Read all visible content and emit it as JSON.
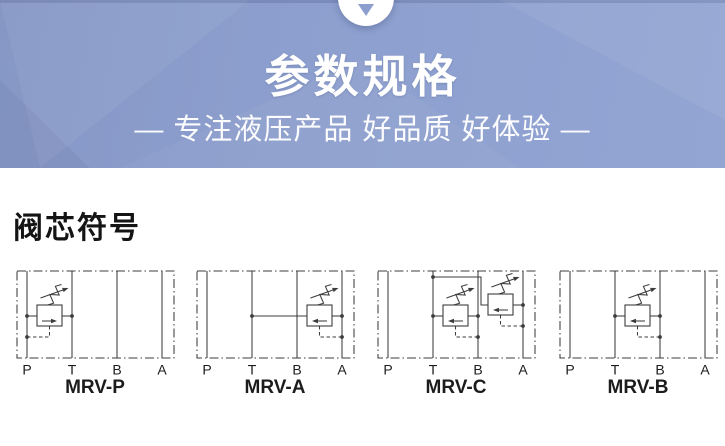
{
  "header": {
    "title": "参数规格",
    "subtitle": "— 专注液压产品  好品质  好体验 —",
    "background_color": "#8c9ecd",
    "text_color": "#ffffff",
    "scroll_indicator_icon": "chevron-down"
  },
  "valve_section": {
    "heading": "阀芯符号",
    "port_labels": [
      "P",
      "T",
      "B",
      "A"
    ],
    "line_color": "#3c3c3c",
    "diagrams": [
      {
        "name": "MRV-P",
        "valves": [
          {
            "relief_from": "P",
            "relief_to": "T",
            "between": [
              "P",
              "T"
            ],
            "flow_arrow": "right",
            "pilot_sense": "P",
            "raised": false
          }
        ]
      },
      {
        "name": "MRV-A",
        "valves": [
          {
            "relief_from": "A",
            "relief_to": "T",
            "between": [
              "B",
              "A"
            ],
            "flow_arrow": "left",
            "pilot_sense": "A",
            "inlet_line_from": "T",
            "raised": false
          }
        ]
      },
      {
        "name": "MRV-C",
        "valves": [
          {
            "relief_from": "B",
            "relief_to": "T",
            "between": [
              "T",
              "B"
            ],
            "flow_arrow": "left",
            "pilot_sense": "B",
            "raised": false
          },
          {
            "relief_from": "A",
            "relief_to": "T",
            "between": [
              "B",
              "A"
            ],
            "flow_arrow": "left",
            "pilot_sense": "A",
            "outlet_top_line_to": "T",
            "raised": true
          }
        ]
      },
      {
        "name": "MRV-B",
        "valves": [
          {
            "relief_from": "B",
            "relief_to": "T",
            "between": [
              "T",
              "B"
            ],
            "flow_arrow": "left",
            "pilot_sense": "B",
            "raised": false
          }
        ]
      }
    ]
  }
}
